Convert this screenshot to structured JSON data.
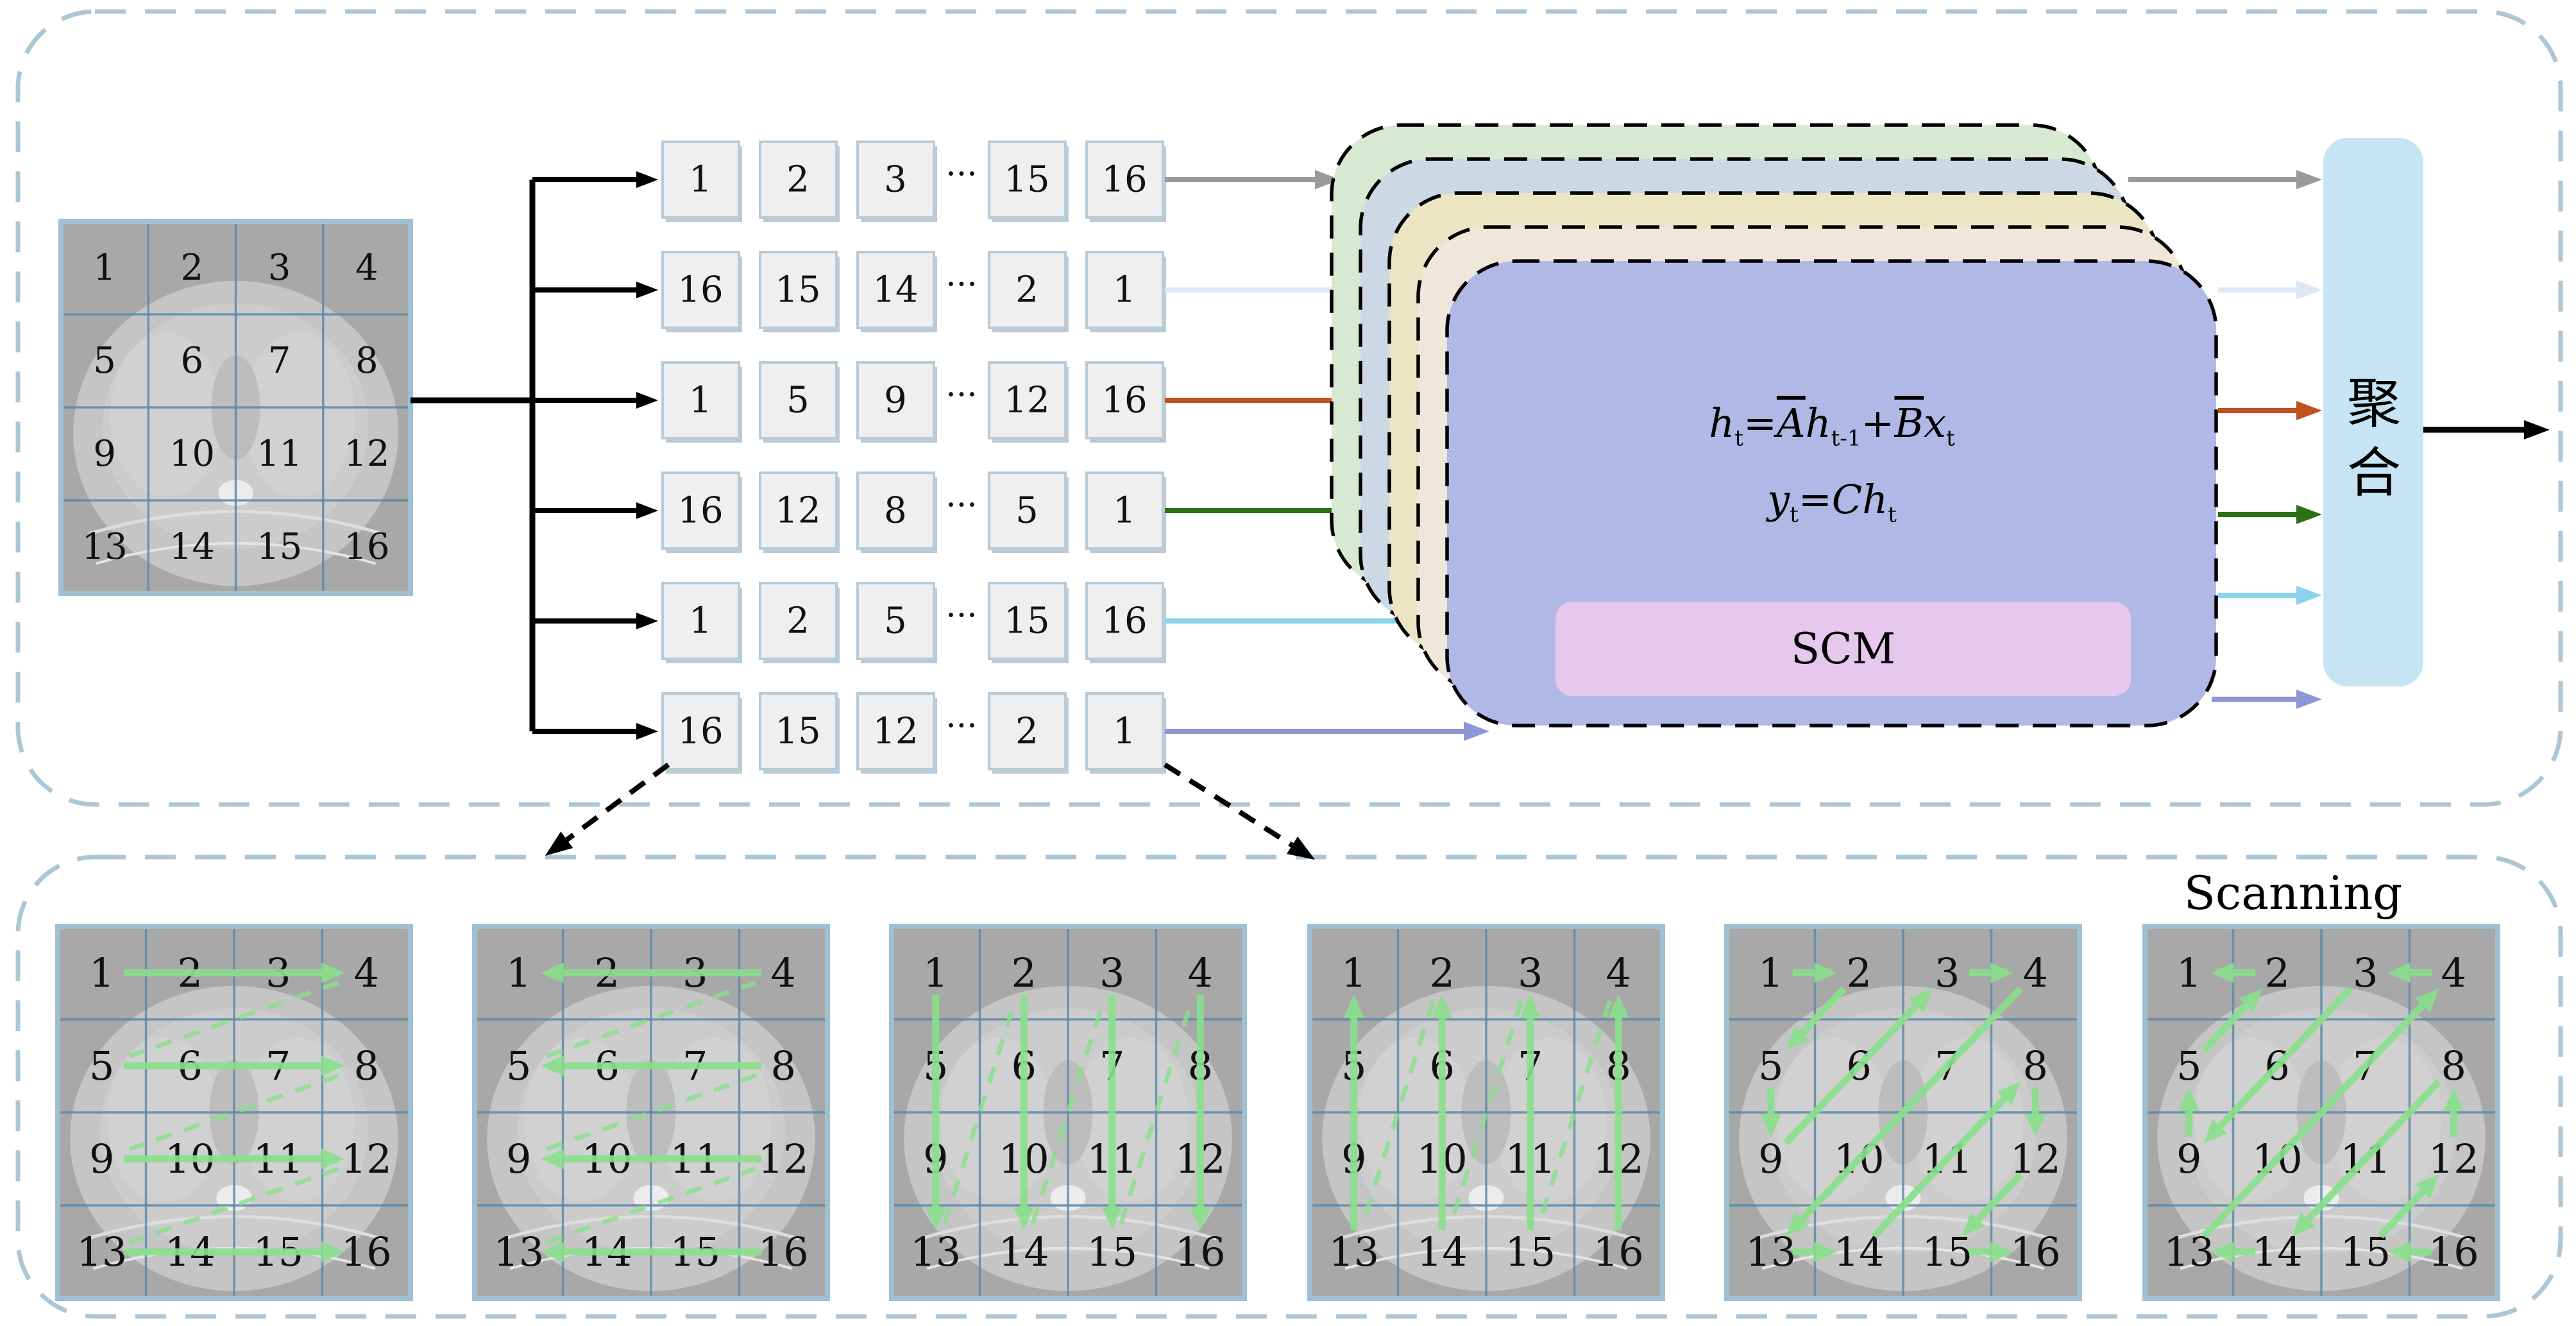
{
  "canvas": {
    "bg": "#ffffff"
  },
  "palette": {
    "panel_dash": "#adc6d6",
    "black": "#000000",
    "seq_box_fill": "#efefef",
    "seq_box_border": "#b7cbd8",
    "seq_box_shadow": "#bccbd6",
    "ct_bg": "#a8a8a8",
    "ct_body": "#c5c5c5",
    "ct_grid_line": "#5d8aa8",
    "ct_frame": "#9fc0d2",
    "scan_arrow_green": "#8ade8c",
    "stack_layers": [
      "#d7e9d0",
      "#ccd9e4",
      "#ece5c3",
      "#efe7da",
      "#b0b8e6"
    ],
    "scm_fill": "#e6c7ee",
    "agg_fill": "#c7e4f4"
  },
  "ct_grid": {
    "numbers": [
      "1",
      "2",
      "3",
      "4",
      "5",
      "6",
      "7",
      "8",
      "9",
      "10",
      "11",
      "12",
      "13",
      "14",
      "15",
      "16"
    ]
  },
  "sequences": [
    {
      "name": "row-forward",
      "color": "#9a9a9a",
      "cells": [
        "1",
        "2",
        "3",
        "···",
        "15",
        "16"
      ]
    },
    {
      "name": "row-reverse",
      "color": "#dbe8f5",
      "cells": [
        "16",
        "15",
        "14",
        "···",
        "2",
        "1"
      ]
    },
    {
      "name": "column-forward",
      "color": "#c1511f",
      "cells": [
        "1",
        "5",
        "9",
        "···",
        "12",
        "16"
      ]
    },
    {
      "name": "column-reverse",
      "color": "#2e7016",
      "cells": [
        "16",
        "12",
        "8",
        "···",
        "5",
        "1"
      ]
    },
    {
      "name": "zigzag-forward",
      "color": "#8cd1ee",
      "cells": [
        "1",
        "2",
        "5",
        "···",
        "15",
        "16"
      ]
    },
    {
      "name": "zigzag-reverse",
      "color": "#8b97d8",
      "cells": [
        "16",
        "15",
        "12",
        "···",
        "2",
        "1"
      ]
    }
  ],
  "ssm": {
    "scm_label": "SCM",
    "equation": {
      "line1": [
        [
          "i",
          "h"
        ],
        [
          "sub",
          "t"
        ],
        [
          "r",
          "="
        ],
        [
          "bar",
          "A"
        ],
        [
          "i",
          "h"
        ],
        [
          "sub",
          "t-1"
        ],
        [
          "r",
          "+"
        ],
        [
          "bar",
          "B"
        ],
        [
          "i",
          "x"
        ],
        [
          "sub",
          "t"
        ]
      ],
      "line2": [
        [
          "i",
          "y"
        ],
        [
          "sub",
          "t"
        ],
        [
          "r",
          "="
        ],
        [
          "i",
          "C"
        ],
        [
          "i",
          "h"
        ],
        [
          "sub",
          "t"
        ]
      ]
    }
  },
  "aggregation": {
    "label": "聚合"
  },
  "scanning": {
    "title": "Scanning",
    "grid_numbers": [
      "1",
      "2",
      "3",
      "4",
      "5",
      "6",
      "7",
      "8",
      "9",
      "10",
      "11",
      "12",
      "13",
      "14",
      "15",
      "16"
    ],
    "grids": [
      {
        "name": "scan-row-forward",
        "solid": [
          [
            1,
            4
          ],
          [
            5,
            8
          ],
          [
            9,
            12
          ],
          [
            13,
            16
          ]
        ],
        "dashed": [
          [
            4,
            5
          ],
          [
            8,
            9
          ],
          [
            12,
            13
          ]
        ]
      },
      {
        "name": "scan-row-reverse",
        "solid": [
          [
            4,
            1
          ],
          [
            8,
            5
          ],
          [
            12,
            9
          ],
          [
            16,
            13
          ]
        ],
        "dashed": [
          [
            13,
            12
          ],
          [
            9,
            8
          ],
          [
            5,
            4
          ]
        ]
      },
      {
        "name": "scan-column-forward",
        "solid": [
          [
            1,
            13
          ],
          [
            2,
            14
          ],
          [
            3,
            15
          ],
          [
            4,
            16
          ]
        ],
        "dashed": [
          [
            13,
            2
          ],
          [
            14,
            3
          ],
          [
            15,
            4
          ]
        ]
      },
      {
        "name": "scan-column-reverse",
        "solid": [
          [
            13,
            1
          ],
          [
            14,
            2
          ],
          [
            15,
            3
          ],
          [
            16,
            4
          ]
        ],
        "dashed": [
          [
            4,
            15
          ],
          [
            3,
            14
          ],
          [
            2,
            13
          ]
        ]
      },
      {
        "name": "scan-zigzag-forward",
        "solid": [
          [
            1,
            2
          ],
          [
            2,
            5
          ],
          [
            5,
            9
          ],
          [
            9,
            3
          ],
          [
            3,
            4
          ],
          [
            4,
            13
          ],
          [
            13,
            14
          ],
          [
            14,
            8
          ],
          [
            8,
            12
          ],
          [
            12,
            15
          ],
          [
            15,
            16
          ]
        ],
        "dashed": []
      },
      {
        "name": "scan-zigzag-reverse",
        "solid": [
          [
            16,
            15
          ],
          [
            15,
            12
          ],
          [
            12,
            8
          ],
          [
            8,
            14
          ],
          [
            14,
            13
          ],
          [
            13,
            4
          ],
          [
            4,
            3
          ],
          [
            3,
            9
          ],
          [
            9,
            5
          ],
          [
            5,
            2
          ],
          [
            2,
            1
          ]
        ],
        "dashed": []
      }
    ]
  }
}
